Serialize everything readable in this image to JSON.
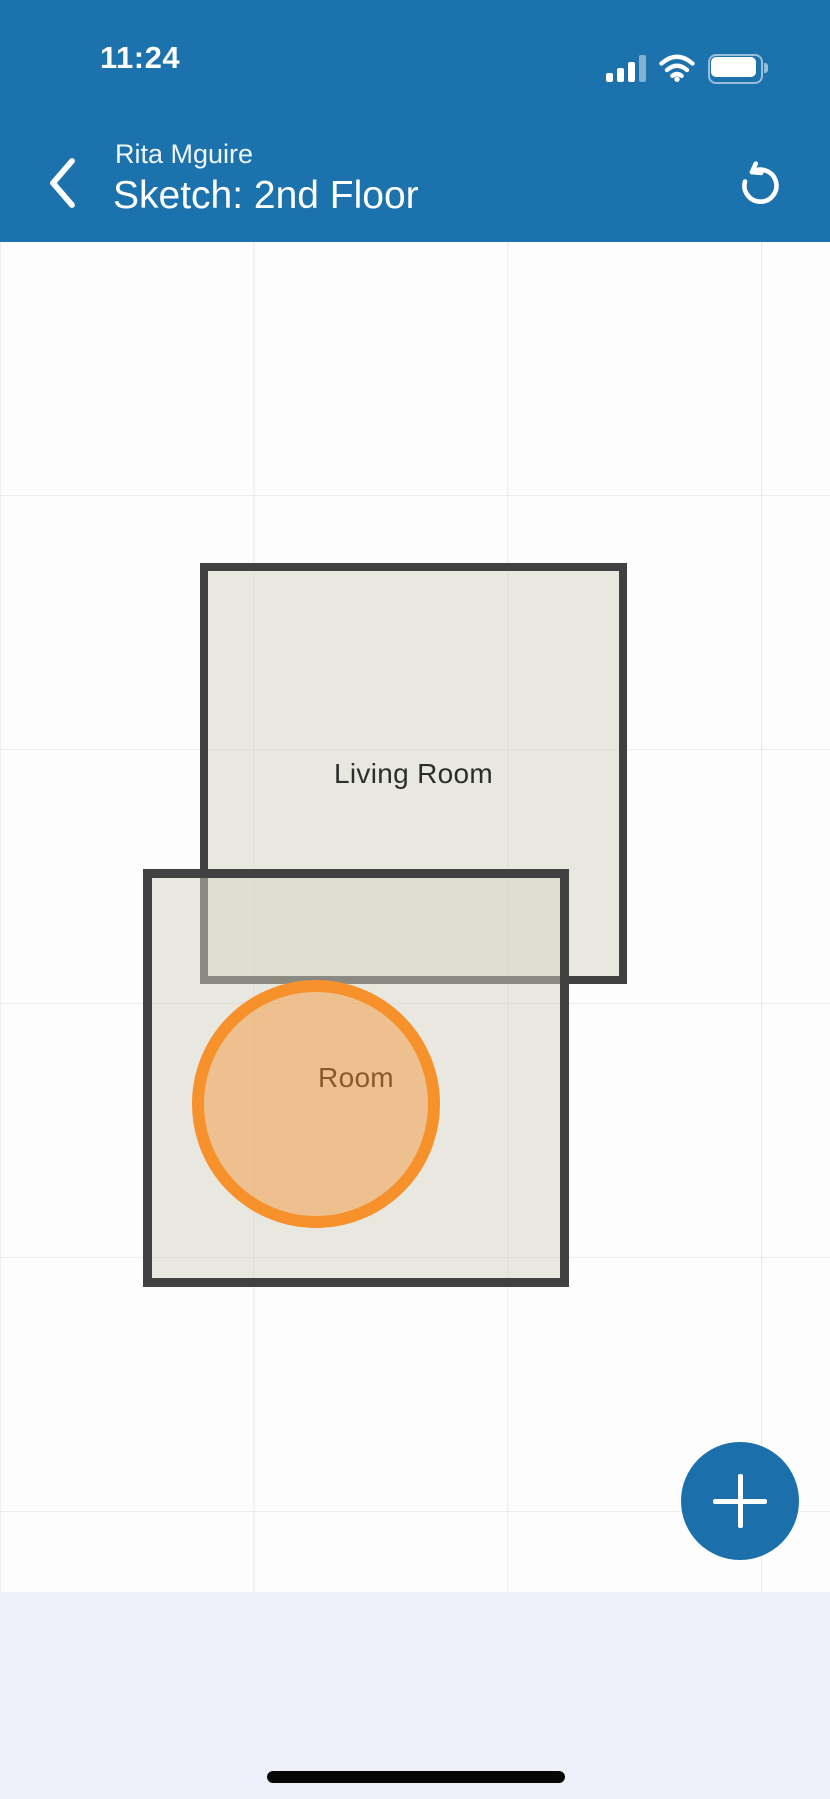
{
  "status_bar": {
    "time": "11:24",
    "signal_icon": "cellular-signal-3-of-4-bars",
    "wifi_icon": "wifi-full",
    "battery_icon": "battery-full"
  },
  "header": {
    "back_icon": "chevron-left",
    "subtitle": "Rita Mguire",
    "title": "Sketch: 2nd Floor",
    "undo_icon": "rotate-counterclockwise",
    "background_color": "#1c72ad"
  },
  "sketch": {
    "grid_visible": true,
    "grid_spacing_px": 254,
    "shapes": [
      {
        "type": "rectangle",
        "label": "Living Room",
        "fill": "#ebebe2",
        "border_color": "#414141"
      },
      {
        "type": "rectangle",
        "label": "Room",
        "fill": "#ebebe2",
        "border_color": "#414141"
      },
      {
        "type": "circle",
        "label": "",
        "fill": "#f3c391",
        "border_color": "#f6912c"
      }
    ]
  },
  "fab": {
    "icon": "plus",
    "background_color": "#1b6fab"
  },
  "colors": {
    "header_blue": "#1c72ad",
    "canvas_background": "#fdfdfd",
    "gridline": "#e8e8e8",
    "shape_border": "#414141",
    "shape_fill": "#ebebe2",
    "circle_orange": "#f6912c",
    "footer_background": "#eef0fa",
    "label_text": "#2d2d2d"
  }
}
